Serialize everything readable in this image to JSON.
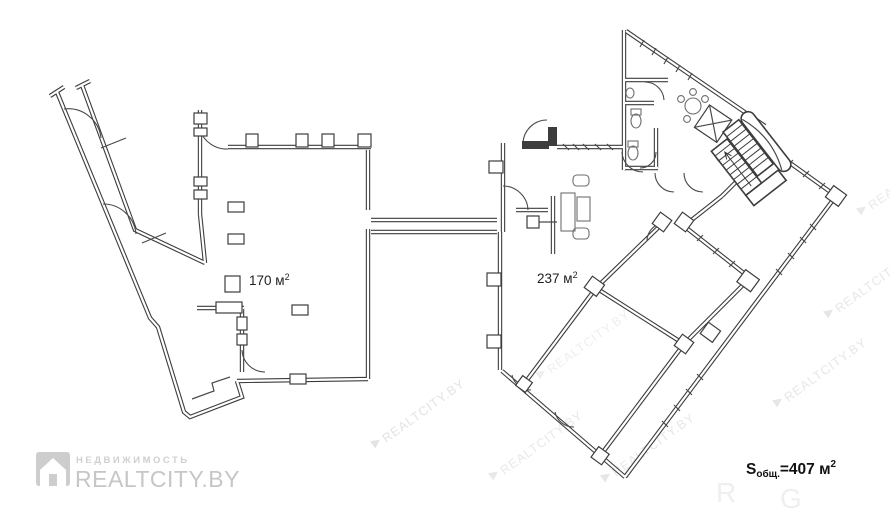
{
  "plan": {
    "area_left": {
      "value": "170 м",
      "sup": "2"
    },
    "area_right": {
      "value": "237 м",
      "sup": "2"
    },
    "total": {
      "s": "S",
      "sub": "общ.",
      "mid": "=407 м",
      "sup": "2"
    }
  },
  "watermark": {
    "text": "REALTCITY.BY",
    "ghost_r": "R",
    "ghost_g": "G"
  },
  "logo": {
    "tagline": "НЕДВИЖИМОСТЬ",
    "brand": "REALTCITY.BY"
  },
  "colors": {
    "wall": "#3d3d3d",
    "label": "#1e1e1e",
    "watermark": "#e1e1e1",
    "logo": "#c6c6c6",
    "background": "#ffffff"
  }
}
